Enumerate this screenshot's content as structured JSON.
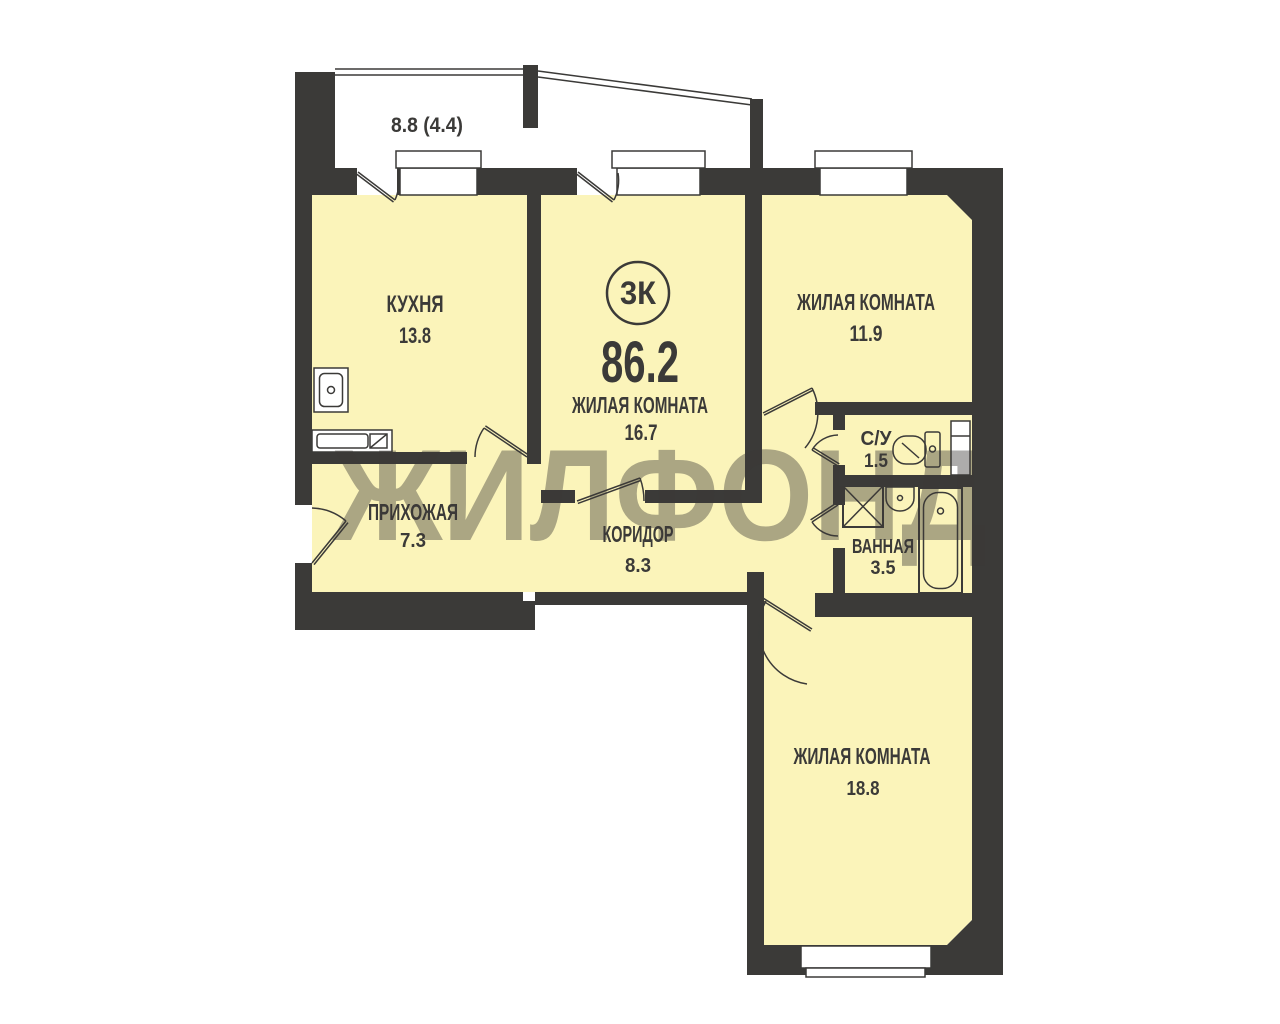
{
  "plan": {
    "badge": "3К",
    "total_area": "86.2",
    "balcony_area": "8.8 (4.4)",
    "watermark": "ЖИЛФОНД",
    "rooms": {
      "kitchen": {
        "name": "КУХНЯ",
        "area": "13.8"
      },
      "living_center": {
        "name": "ЖИЛАЯ КОМНАТА",
        "area": "16.7"
      },
      "living_right": {
        "name": "ЖИЛАЯ КОМНАТА",
        "area": "11.9"
      },
      "living_bottom": {
        "name": "ЖИЛАЯ КОМНАТА",
        "area": "18.8"
      },
      "hallway": {
        "name": "ПРИХОЖАЯ",
        "area": "7.3"
      },
      "corridor": {
        "name": "КОРИДОР",
        "area": "8.3"
      },
      "wc": {
        "name": "С/У",
        "area": "1.5"
      },
      "bath": {
        "name": "ВАННАЯ",
        "area": "3.5"
      }
    },
    "colors": {
      "wall": "#3b3a38",
      "room_fill": "#fbf4ba",
      "text": "#3b3a38",
      "watermark": "#554b25",
      "background": "#ffffff"
    }
  }
}
